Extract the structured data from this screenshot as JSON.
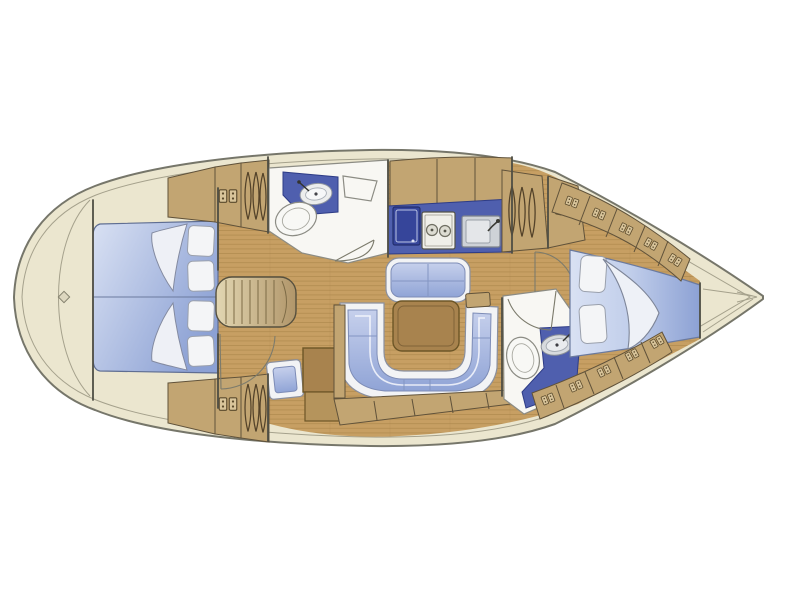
{
  "diagram": {
    "kind": "sailing-yacht-interior-floor-plan",
    "view": "top-down",
    "bow_direction": "right"
  },
  "parts": {
    "hull": "hull outline with side-deck band",
    "stern_deck": "rounded stern deck with contour line and deck fitting",
    "aft_cabin": "full-beam aft double cabin with two berths, four pillows, folded sheets",
    "aft_storage": "aft lockers and hanging wardrobe (port and starboard)",
    "aft_head": "aft bathroom with washbasin counter, toilet and shower seat",
    "companionway": "companionway steps with door swings and stool",
    "nav_station": "chart table units beside companionway",
    "galley": "galley counter with fridge, two-burner stove and sink",
    "salon": "salon with forward bench seat, table and U-shaped settee",
    "forward_head": "forward bathroom with toilet and washbasin counter",
    "forward_cabin": "V-berth forward cabin with two pillows and folded duvet",
    "bow_locker": "anchor locker in bow tip"
  },
  "icons": [
    "hanger-icon",
    "locker-icon",
    "stove-burner-icon",
    "faucet-icon",
    "deck-fitting-diamond-icon"
  ],
  "colors": {
    "background": "#ffffff",
    "hull_outline": "#76766a",
    "deck_cream": "#ebe6cf",
    "deck_line": "#a5a18c",
    "wood_floor": "#c79f63",
    "wood_plank_line": "#a07b41",
    "cabinet_wood": "#c2a572",
    "cabinet_outline": "#60523a",
    "counter_blue": "#4f5fae",
    "appliance_navy": "#36459a",
    "blue_dark_outline": "#2e3c86",
    "mattress_light": "#d9e1f3",
    "mattress_deep": "#8ca1d4",
    "cushion_blue_light": "#c6d0ec",
    "cushion_blue": "#90a4d6",
    "upholstery_white": "#f2f3f5",
    "upholstery_outline": "#8a90a0",
    "fixture_white": "#f8f7f3",
    "fixture_outline": "#8c8c84",
    "steel": "#ced2d7",
    "steel_dark": "#9aa0a8",
    "table_brown": "#a8834e",
    "table_outline": "#6d5627",
    "steps_light": "#e2d6b2",
    "steps_dark": "#b1966a",
    "wall_line": "#4f4e44",
    "door_line": "#7c7b6c"
  }
}
